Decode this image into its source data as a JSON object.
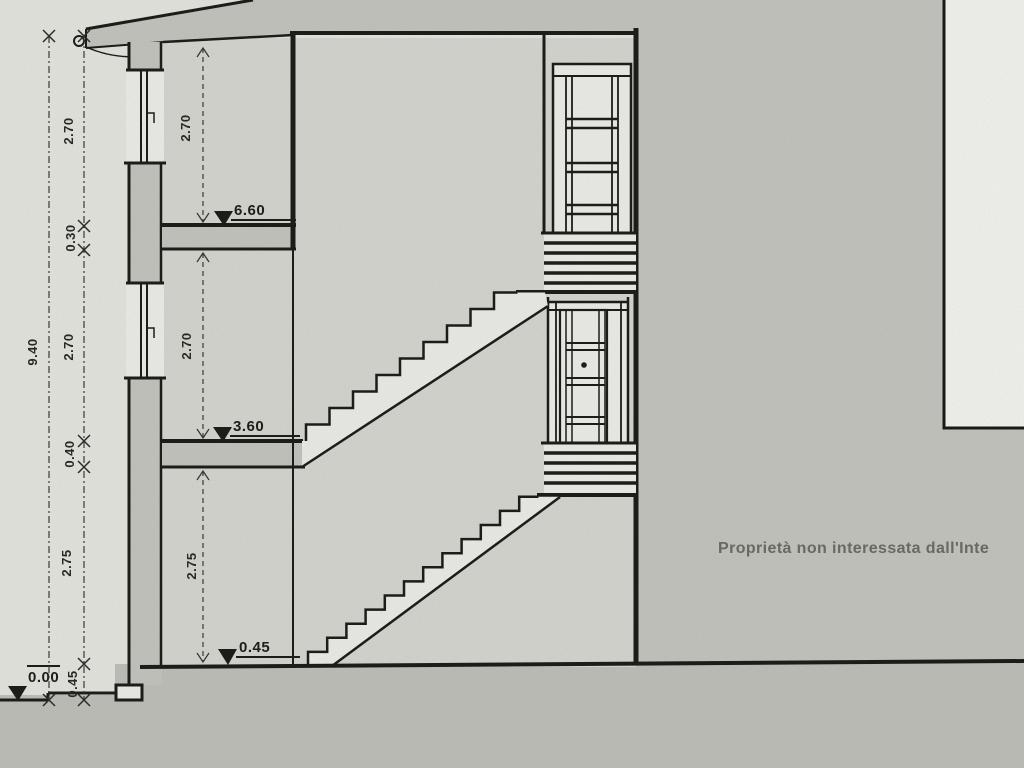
{
  "drawing": {
    "type": "building section (scanned architectural drawing)",
    "dimension_chain": {
      "total": "9.40",
      "segments": [
        "2.70",
        "0.30",
        "2.70",
        "0.40",
        "2.75",
        "0.45"
      ]
    },
    "room_heights": [
      "2.70",
      "2.70",
      "2.75"
    ],
    "levels": {
      "top_floor": "6.60",
      "first_floor": "3.60",
      "ground_floor": "0.45",
      "terrain": "0.00"
    },
    "annotation": "Proprietà non interessata dall'Inte",
    "colors": {
      "paper": "#e9eae4",
      "shade_gray": "#c7c9c2",
      "interior_gray": "#d9dbd4",
      "opening_white": "#f2f2ee",
      "line": "#1e1f1b",
      "annotation_text": "#6e7166"
    }
  }
}
